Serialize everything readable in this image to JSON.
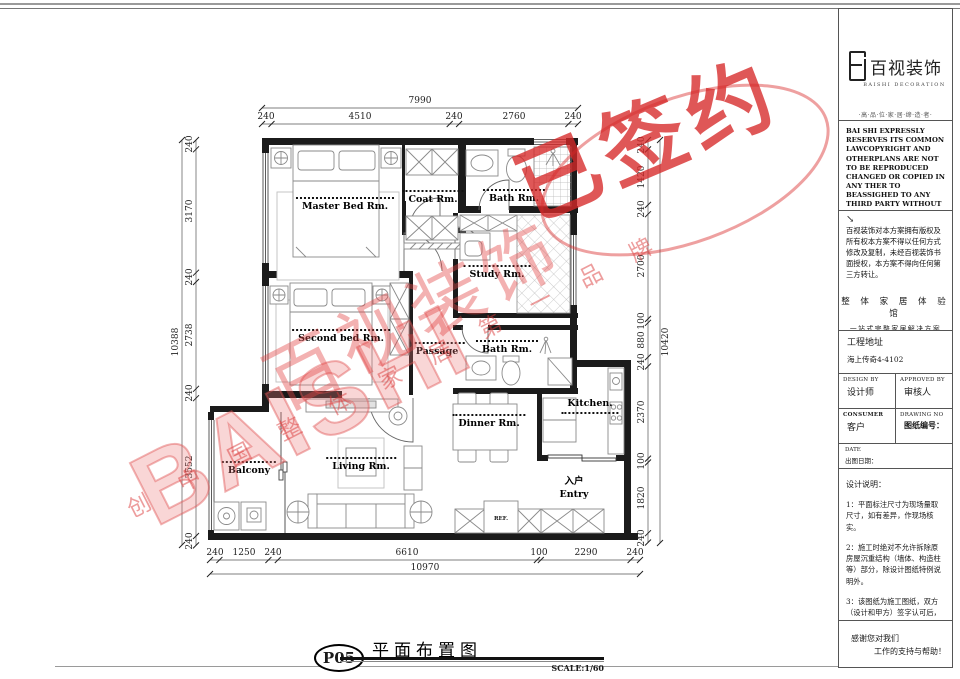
{
  "rooms": {
    "master": "Master Bed Rm.",
    "coat": "Coat Rm.",
    "bath1": "Bath Rm.",
    "study": "Study Rm.",
    "second": "Second bed Rm.",
    "passage": "Passage",
    "bath2": "Bath Rm.",
    "kitchen": "Kitchen.",
    "dinner": "Dinner Rm.",
    "living": "Living Rm.",
    "balcony": "Balcony",
    "entry_cn": "入户",
    "entry_en": "Entry",
    "ref": "REF."
  },
  "dims": {
    "top": {
      "total": "7990",
      "segs": [
        "240",
        "4510",
        "240",
        "2760",
        "240"
      ]
    },
    "left": {
      "total": "10388",
      "segs": [
        "240",
        "3170",
        "240",
        "2738",
        "240",
        "3552",
        "240"
      ]
    },
    "right": {
      "total": "10420",
      "segs": [
        "240",
        "1420",
        "240",
        "2700",
        "100",
        "880",
        "240",
        "2370",
        "100",
        "1820",
        "240"
      ]
    },
    "bottom": {
      "total": "10970",
      "segs": [
        "240",
        "1250",
        "240",
        "6610",
        "100",
        "2290",
        "240"
      ]
    }
  },
  "titlebar": {
    "page_no": "P05",
    "title": "平面布置图",
    "scale": "SCALE:1/60"
  },
  "watermark": {
    "stamp": "已签约",
    "brand_cn": "百视装饰",
    "brand_en": "BAISHI",
    "slogan": "创 中 国 整 体 家 居 第 一 品 牌"
  },
  "panel": {
    "logo_cn": "百视装饰",
    "logo_en": "BAISHI DECORATION",
    "tagline": "·高·品·位·家·居·缔·造·者·",
    "legal_en": "BAI SHI EXPRESSLY RESERVES ITS COMMON LAWCOPYRIGHT AND OTHERPLANS ARE NOT TO BE REPRODUCED CHANGED OR COPIED IN ANY THER TO BEASSIGHED TO ANY THIRD PARTY WITHOUT FIRST OSTANDING THE EXPRESSED WRITTEN PERMISSION AND CONSENT OF BAI SHI DECORATION",
    "arrow": "↘",
    "legal_cn": "百视装饰对本方案拥有版权及所有权本方案不得以任何方式修改及复制，未经百视装饰书面授权，本方案不得向任何第三方转让。",
    "slogan1": "整 体 家 居 体 验 馆",
    "slogan2": "一站式完整家居解决方案",
    "address_label": "工程地址",
    "address_value": "海上传奇4-4102",
    "design_by_en": "DESIGN BY",
    "design_by_cn": "设计师",
    "approved_by_en": "APPROVED BY",
    "approved_by_cn": "审核人",
    "consumer_en": "CONSUMER",
    "consumer_cn": "客户",
    "drawing_no_en": "DRAWING NO",
    "drawing_no_cn": "图纸编号：",
    "date_en": "DATE",
    "date_cn": "出图日期：",
    "notes_title": "设计说明：",
    "notes": [
      "1：平面标注尺寸为现场量取尺寸，如有差异，作现场核实。",
      "2：施工时绝对不允许拆除原房屋沉重结构（墙体、构造柱等）部分，除设计图纸特例说明外。",
      "3：该图纸为施工图纸，双方（设计和甲方）签字认可后，方可作为施工依据。"
    ],
    "thanks1": "感谢您对我们",
    "thanks2": "工作的支持与帮助！"
  }
}
